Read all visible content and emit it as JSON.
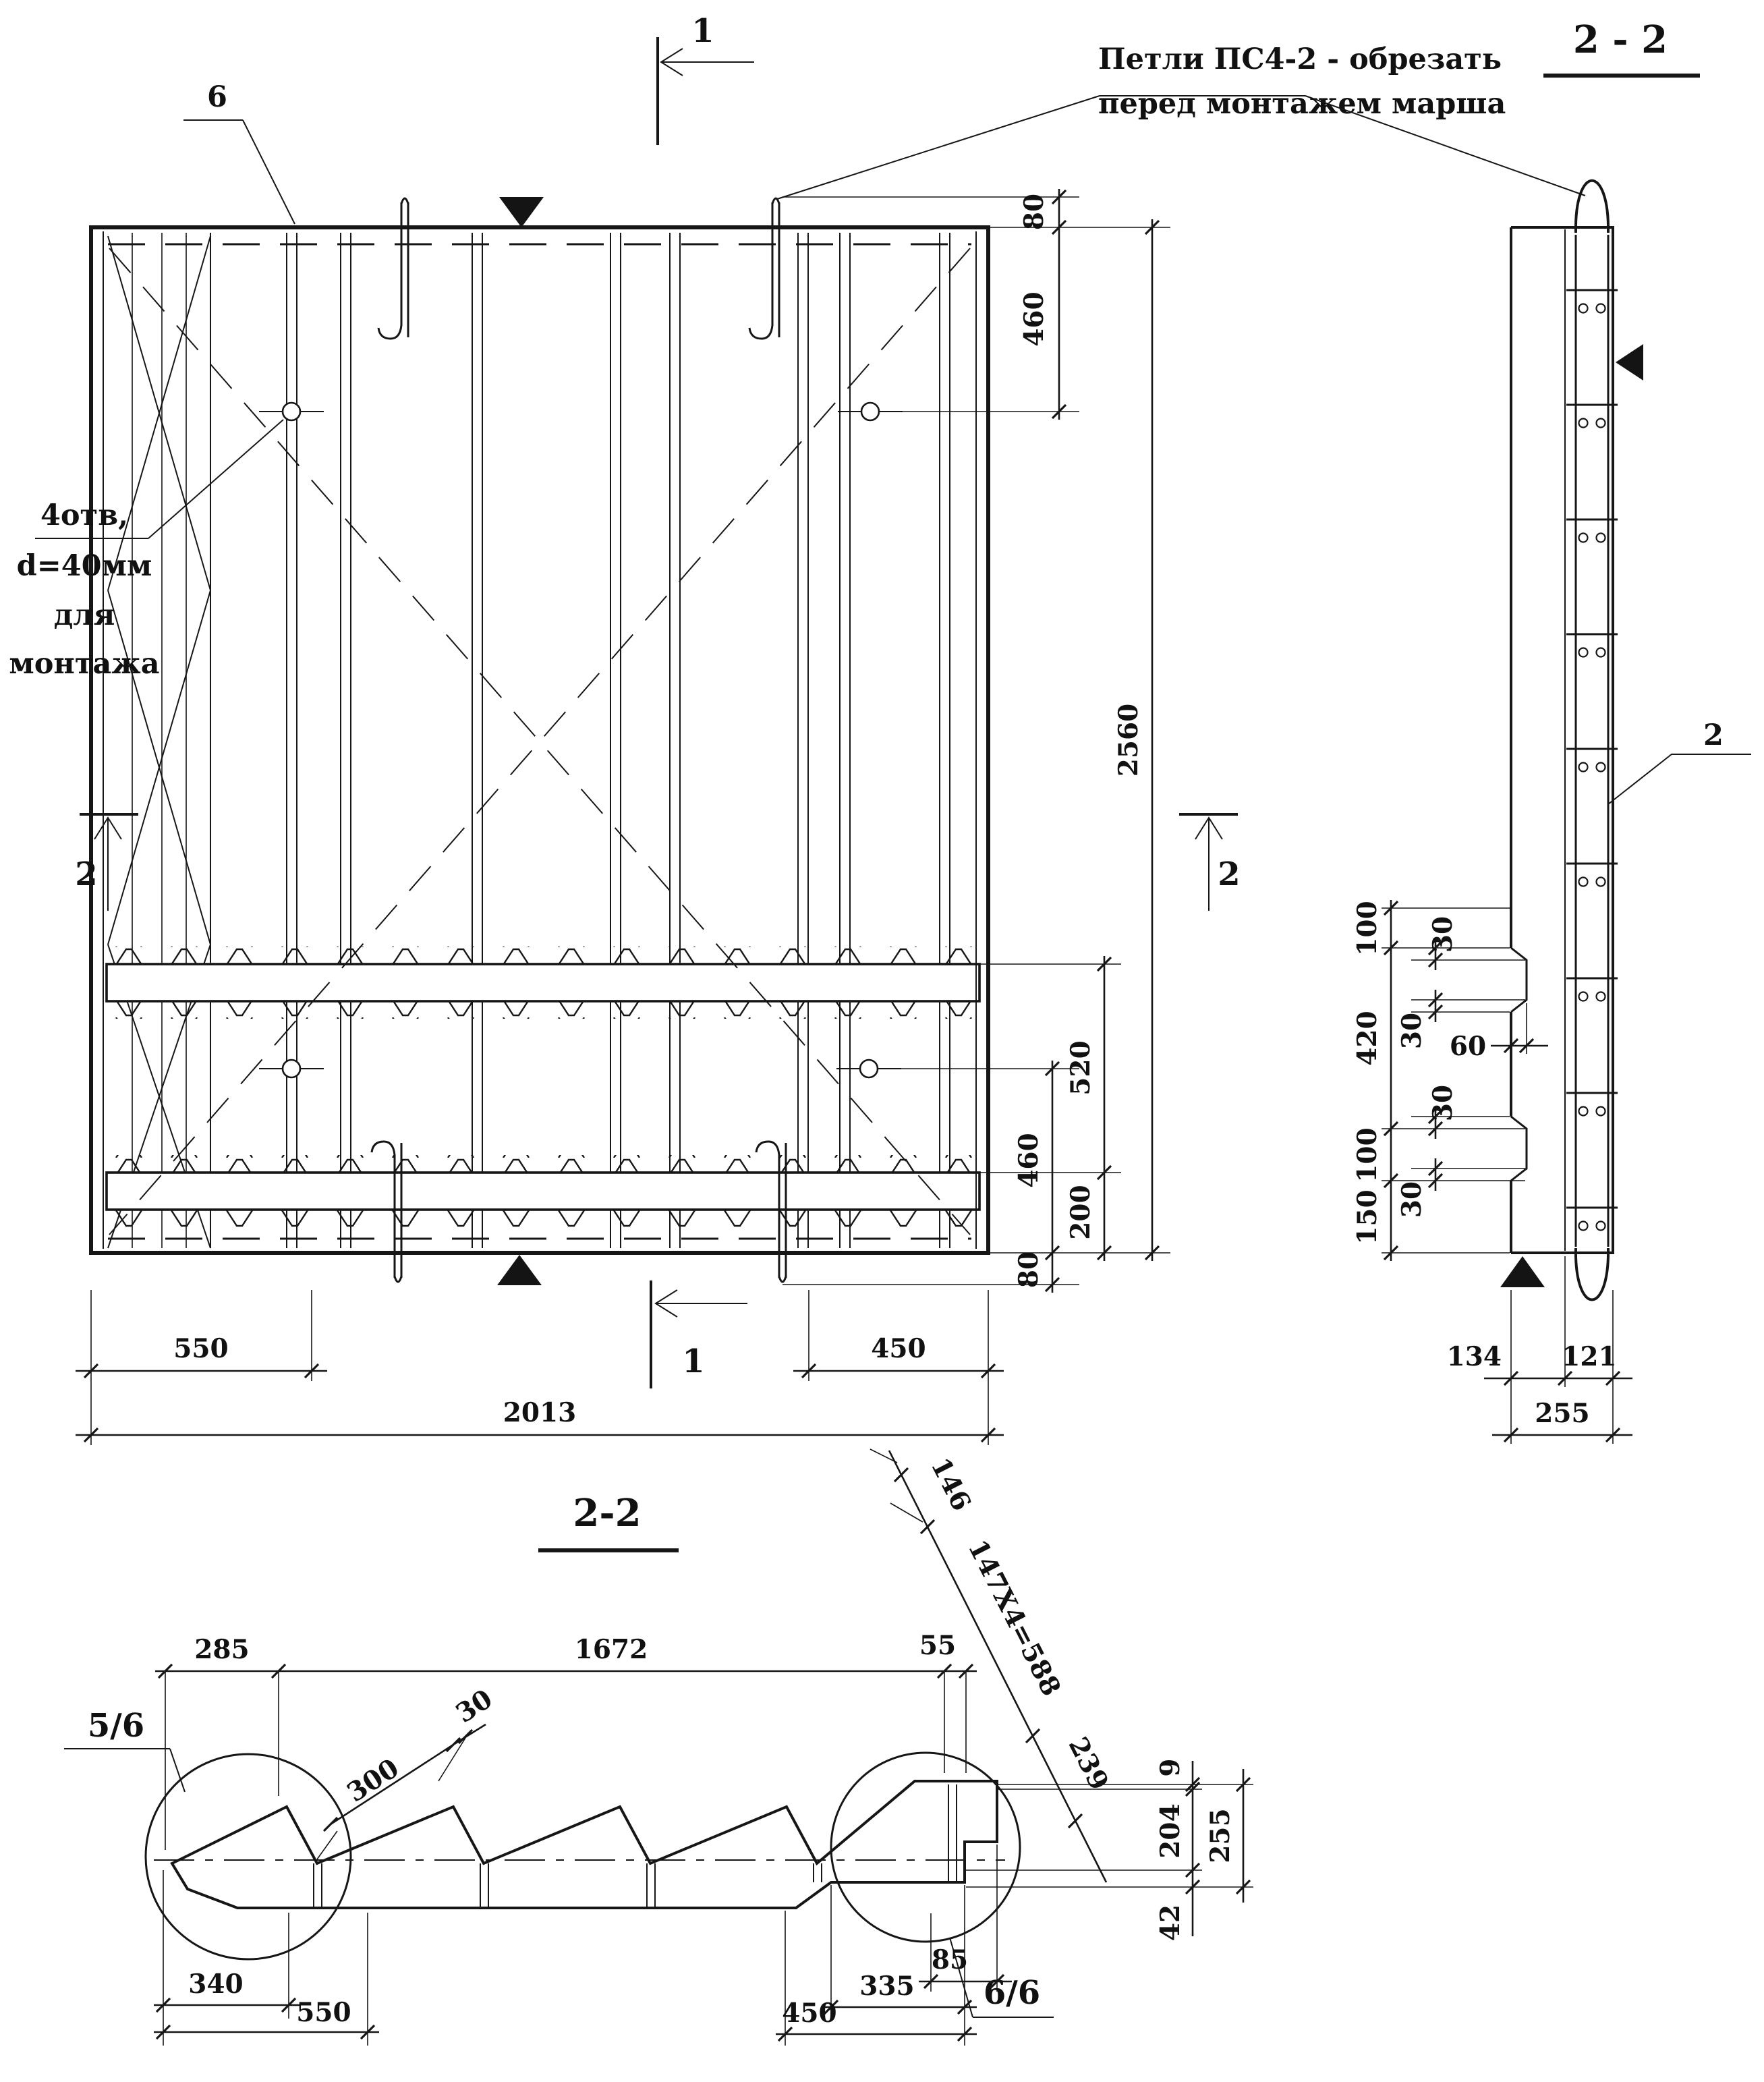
{
  "annotations": {
    "note1": "Петли ПС4-2 - обрезать",
    "note2": "перед монтажем марша",
    "holes1": "4отв,",
    "holes2": "d=40мм",
    "holes3": "для",
    "holes4": "монтажа",
    "side_title": "2 - 2",
    "bottom_title": "2-2",
    "marker1": "1",
    "marker2": "2",
    "callout6": "6",
    "callout2": "2",
    "detail_left": "5/6",
    "detail_right": "6/6"
  },
  "plan_dims": {
    "hook_top": "80",
    "top_hole": "460",
    "total_h": "2560",
    "rib": "520",
    "hole_bot": "460",
    "bot": "200",
    "hook_bot": "80",
    "left": "550",
    "right": "450",
    "total_w": "2013"
  },
  "side_dims": {
    "a100": "100",
    "b30": "30",
    "c30": "30",
    "mid420": "420",
    "d30": "30",
    "e100": "100",
    "f30": "30",
    "g150": "150",
    "notch": "60",
    "w134": "134",
    "w121": "121",
    "w255": "255"
  },
  "section_dims": {
    "l285": "285",
    "m1672": "1672",
    "r55": "55",
    "tread": "300",
    "nose": "30",
    "top146": "146",
    "run": "147X4=588",
    "end239": "239",
    "v9": "9",
    "v204": "204",
    "v255": "255",
    "v42": "42",
    "b340": "340",
    "b550": "550",
    "b450": "450",
    "b335": "335",
    "b85": "85"
  }
}
